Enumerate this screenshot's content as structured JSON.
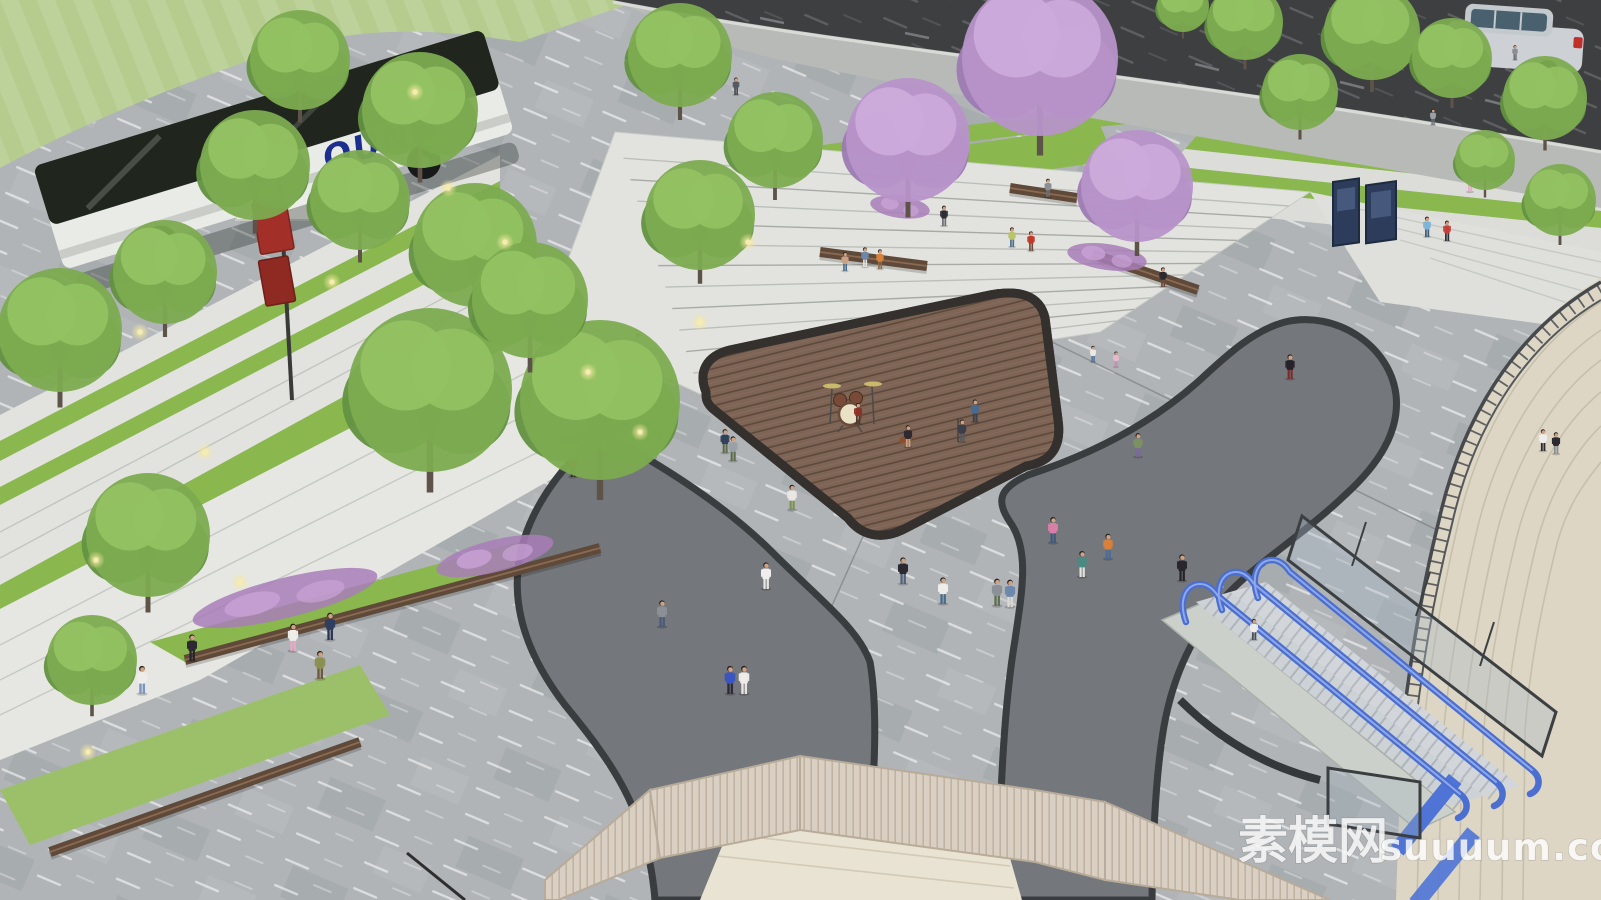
{
  "watermark": {
    "cn": "素模网",
    "domain": "suuuum.com"
  },
  "bus": {
    "text": "OUND",
    "text_color": "#1d2f8e"
  },
  "palette": {
    "plaza_light": "#b0b4b7",
    "plaza_dark_band": "#74777b",
    "charcoal_curb": "#3a3d40",
    "stage_wood": "#7d6455",
    "stage_border": "#33302d",
    "step_stone": "#e2e3de",
    "hedge_green": "#8ab84e",
    "lawn_green": "#b6cc8f",
    "tree_green": "#7cab50",
    "blossom_purple": "#b793c9",
    "flower_purple": "#a87cb8",
    "bench_wood": "#5f4938",
    "escalator_blue": "#4a6fd0",
    "beige_stair": "#ddd6c5",
    "fence_tan": "#d9cfc2",
    "road_asphalt": "#3e3f41",
    "bus_glass": "#20261e",
    "banner_red": "#a33028",
    "kiosk_navy": "#2c3c5a"
  },
  "scene": {
    "people": [
      [
        736,
        95,
        "#555a60",
        "#3c4044",
        0.5
      ],
      [
        944,
        226,
        "#2e2d33",
        "#6b6f75",
        0.58
      ],
      [
        1012,
        247,
        "#b9c46a",
        "#4a6b8a",
        0.56
      ],
      [
        1031,
        251,
        "#c0392b",
        "#6e4a38",
        0.56
      ],
      [
        1470,
        192,
        "#f0eef0",
        "#e8a8c8",
        0.56
      ],
      [
        1427,
        237,
        "#7db3d8",
        "#3e5a78",
        0.58
      ],
      [
        1447,
        241,
        "#c24038",
        "#2e2e34",
        0.58
      ],
      [
        1515,
        60,
        "#8a8f95",
        "#5a5f66",
        0.42
      ],
      [
        1433,
        125,
        "#9aa0a6",
        "#6a7076",
        0.46
      ],
      [
        1348,
        26,
        "#8a8f95",
        "#4a4e55",
        0.42
      ],
      [
        528,
        410,
        "#3a3540",
        "#d87fa8",
        0.68
      ],
      [
        638,
        356,
        "#e8e6e2",
        "#8a8288",
        0.64
      ],
      [
        858,
        424,
        "#8a3226",
        "#4a3a30",
        0.6,
        "drummer"
      ],
      [
        908,
        447,
        "#2e2a30",
        "#caa183",
        0.62,
        "guitarist"
      ],
      [
        962,
        442,
        "#3c3f4a",
        "#55585f",
        0.64,
        "singer"
      ],
      [
        975,
        422,
        "#4a6a8c",
        "#39414e",
        0.64,
        "dancer"
      ],
      [
        1093,
        362,
        "#ece9e4",
        "#4a6b9c",
        0.46,
        "jumping-kid"
      ],
      [
        1116,
        367,
        "#e8b8cc",
        "#c88aa8",
        0.44,
        "jumping-kid"
      ],
      [
        725,
        453,
        "#32415a",
        "#5c6b4a",
        0.68
      ],
      [
        792,
        510,
        "#e9e7e3",
        "#7c9150",
        0.72
      ],
      [
        903,
        584,
        "#2c2830",
        "#54617a",
        0.76
      ],
      [
        943,
        604,
        "#efedea",
        "#4a6b8a",
        0.76
      ],
      [
        997,
        606,
        "#8c9197",
        "#5e7050",
        0.78
      ],
      [
        1010,
        607,
        "#6c88aa",
        "#dad8d4",
        0.78
      ],
      [
        1082,
        577,
        "#4a8a80",
        "#e5e3df",
        0.74
      ],
      [
        1108,
        559,
        "#d8813a",
        "#4a6b9c",
        0.72
      ],
      [
        1138,
        457,
        "#7c9162",
        "#7a6a9a",
        0.68
      ],
      [
        1290,
        379,
        "#26222a",
        "#7a2a28",
        0.7,
        "rocker"
      ],
      [
        1182,
        581,
        "#2a262e",
        "#26222a",
        0.76
      ],
      [
        730,
        694,
        "#3a55c0",
        "#2e2a38",
        0.8
      ],
      [
        744,
        694,
        "#efecea",
        "#e8e5e0",
        0.8
      ],
      [
        766,
        589,
        "#f0eeec",
        "#e8e6e2",
        0.76
      ],
      [
        662,
        627,
        "#8c8f96",
        "#4a5a78",
        0.76
      ],
      [
        142,
        694,
        "#efedea",
        "#7c94c4",
        0.8
      ],
      [
        320,
        679,
        "#8a9150",
        "#6e5a3a",
        0.8
      ],
      [
        192,
        661,
        "#2c2a30",
        "#26242a",
        0.76
      ],
      [
        97,
        696,
        "#d8813a",
        "#8a6a4a",
        0.76
      ],
      [
        293,
        651,
        "#efedea",
        "#e8a8c8",
        0.78
      ],
      [
        330,
        640,
        "#2e3e5e",
        "#2a3650",
        0.78
      ],
      [
        573,
        477,
        "#b03028",
        "#2e2a30",
        0.7
      ],
      [
        600,
        459,
        "#e8e6e2",
        "#6c88aa",
        0.68
      ],
      [
        733,
        461,
        "#9aa0a6",
        "#5c6b4a",
        0.7
      ],
      [
        1048,
        197,
        "#8a8f95",
        "#6a7076",
        0.52
      ],
      [
        1163,
        287,
        "#2c2a30",
        "#6e4a38",
        0.56
      ],
      [
        865,
        267,
        "#6c88aa",
        "#e8e6e2",
        0.56
      ],
      [
        880,
        269,
        "#d8813a",
        "#8a6a4a",
        0.56
      ],
      [
        845,
        271,
        "#caa183",
        "#4a6b8a",
        0.54
      ],
      [
        1053,
        543,
        "#d87fa8",
        "#3e5a78",
        0.74
      ],
      [
        1254,
        640,
        "#efedea",
        "#4a4e55",
        0.6,
        "escalator-rider"
      ],
      [
        1543,
        451,
        "#efedea",
        "#2e2a30",
        0.62
      ],
      [
        1556,
        454,
        "#2c2a30",
        "#8a8f95",
        0.62
      ]
    ],
    "trees": {
      "green": [
        [
          60,
          330,
          62
        ],
        [
          165,
          272,
          52
        ],
        [
          300,
          60,
          50
        ],
        [
          255,
          165,
          55
        ],
        [
          420,
          110,
          58
        ],
        [
          475,
          245,
          62
        ],
        [
          430,
          390,
          82
        ],
        [
          600,
          400,
          80
        ],
        [
          530,
          300,
          58
        ],
        [
          680,
          55,
          52
        ],
        [
          148,
          535,
          62
        ],
        [
          92,
          660,
          45
        ],
        [
          360,
          200,
          50
        ],
        [
          700,
          215,
          55
        ],
        [
          775,
          140,
          48
        ],
        [
          1245,
          22,
          38
        ],
        [
          1372,
          32,
          48
        ],
        [
          1452,
          58,
          40
        ],
        [
          1545,
          98,
          42
        ],
        [
          1300,
          92,
          38
        ],
        [
          1183,
          6,
          26
        ],
        [
          1560,
          200,
          36
        ],
        [
          1485,
          160,
          30
        ]
      ],
      "purple": [
        [
          1040,
          58,
          78
        ],
        [
          908,
          140,
          62
        ],
        [
          1137,
          186,
          56
        ]
      ]
    },
    "lights": [
      [
        140,
        332
      ],
      [
        205,
        452
      ],
      [
        415,
        92
      ],
      [
        505,
        242
      ],
      [
        588,
        372
      ],
      [
        640,
        432
      ],
      [
        700,
        322
      ],
      [
        748,
        242
      ],
      [
        240,
        582
      ],
      [
        88,
        752
      ],
      [
        448,
        188
      ],
      [
        332,
        282
      ],
      [
        96,
        560
      ]
    ],
    "benches": [
      [
        50,
        852,
        360,
        742
      ],
      [
        185,
        660,
        600,
        548
      ],
      [
        560,
        442,
        632,
        424
      ],
      [
        820,
        252,
        927,
        266
      ],
      [
        1010,
        188,
        1077,
        198
      ],
      [
        1092,
        254,
        1198,
        290
      ]
    ],
    "flowerbeds": [
      [
        285,
        598,
        95,
        20,
        -14
      ],
      [
        495,
        556,
        60,
        16,
        -14
      ],
      [
        430,
        368,
        44,
        13,
        -27
      ],
      [
        1107,
        257,
        40,
        13,
        8
      ],
      [
        900,
        207,
        30,
        11,
        8
      ]
    ]
  }
}
